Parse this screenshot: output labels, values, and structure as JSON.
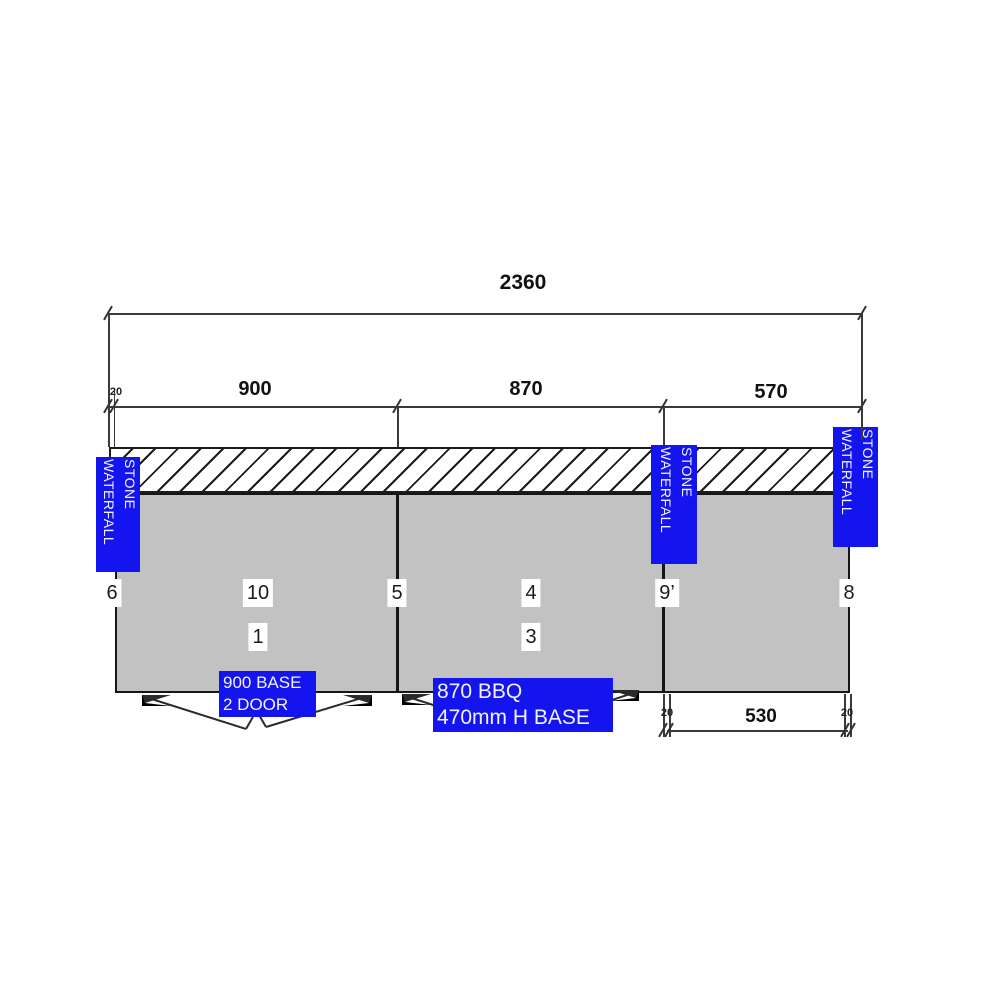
{
  "drawing": {
    "overall": "2360",
    "seg_offset_left": "20",
    "segments": [
      "900",
      "870",
      "570"
    ],
    "bottom": {
      "offset_left": "20",
      "span": "530",
      "offset_right": "20"
    },
    "stone_labels": [
      {
        "line1": "STONE",
        "line2": "WATERFALL"
      },
      {
        "line1": "STONE",
        "line2": "WATERFALL"
      },
      {
        "line1": "STONE",
        "line2": "WATERFALL"
      }
    ],
    "labels": {
      "base900_line1": "900 BASE",
      "base900_line2": "2 DOOR",
      "bbq870_line1": "870 BBQ",
      "bbq870_line2": "470mm H BASE"
    },
    "markers": {
      "m6": "6",
      "m10": "10",
      "m5": "5",
      "m4": "4",
      "m9": "9’",
      "m8": "8",
      "m1": "1",
      "m3": "3"
    },
    "colors": {
      "accent_blue": "#1414ee",
      "cabinet_fill": "#c2c2c2",
      "line_color": "#222222"
    }
  }
}
